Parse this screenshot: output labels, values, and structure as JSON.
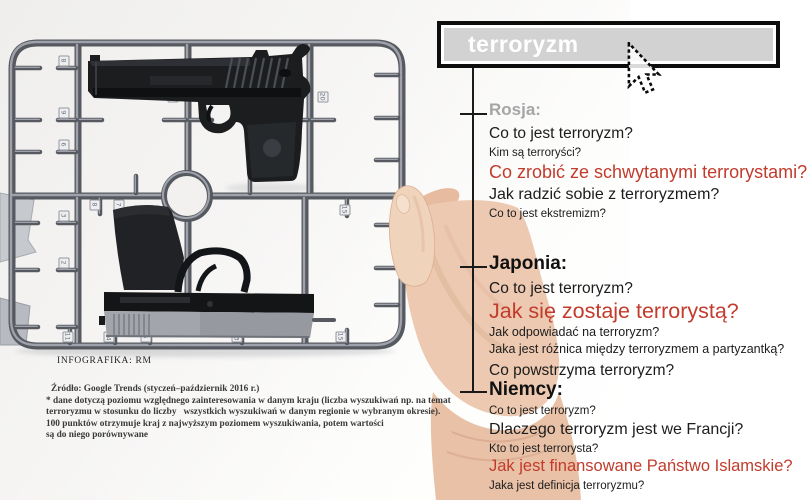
{
  "search": {
    "query": "terroryzm"
  },
  "colors": {
    "accent_red": "#c23b2c",
    "header_gray": "#a5a5a5",
    "searchbox_fill": "#d2d2d2",
    "searchbox_border": "#0d0d0d",
    "searchbox_text": "#ffffff"
  },
  "sections": [
    {
      "header": "Rosja:",
      "items": [
        {
          "text": "Co to jest terroryzm?"
        },
        {
          "text": "Kim są terroryści?"
        },
        {
          "text": "Co zrobić ze schwytanymi terrorystami?"
        },
        {
          "text": "Jak radzić sobie z terroryzmem?"
        },
        {
          "text": "Co to jest ekstremizm?"
        }
      ]
    },
    {
      "header": "Japonia:",
      "items": [
        {
          "text": "Co to jest terroryzm?"
        },
        {
          "text": "Jak się zostaje terrorystą?"
        },
        {
          "text": "Jak odpowiadać na terroryzm?"
        },
        {
          "text": "Jaka jest różnica między terroryzmem a partyzantką?"
        },
        {
          "text": "Co powstrzyma terroryzm?"
        }
      ]
    },
    {
      "header": "Niemcy:",
      "items": [
        {
          "text": "Co to jest terroryzm?"
        },
        {
          "text": "Dlaczego terroryzm jest we Francji?"
        },
        {
          "text": "Kto to jest terrorysta?"
        },
        {
          "text": "Jak jest finansowane Państwo Islamskie?"
        },
        {
          "text": "Jaka jest definicja terroryzmu?"
        }
      ]
    }
  ],
  "credit": "INFOGRAFIKA: RM",
  "source": {
    "lines": [
      "Źródło: Google Trends (styczeń–październik 2016 r.)",
      "* dane dotyczą poziomu względnego zainteresowania w danym kraju (liczba wyszukiwań np. na temat",
      "terroryzmu w stosunku do liczby   wszystkich wyszukiwań w danym regionie w wybranym okresie).",
      "100 punktów otrzymuje kraj z najwyższym poziomem wyszukiwania, potem wartości",
      "są do niego porównywane"
    ]
  },
  "sprue": {
    "tags": [
      "8",
      "9",
      "6",
      "12",
      "20",
      "3",
      "2",
      "8",
      "7",
      "15",
      "11",
      "14",
      "5",
      "13",
      "15"
    ]
  }
}
